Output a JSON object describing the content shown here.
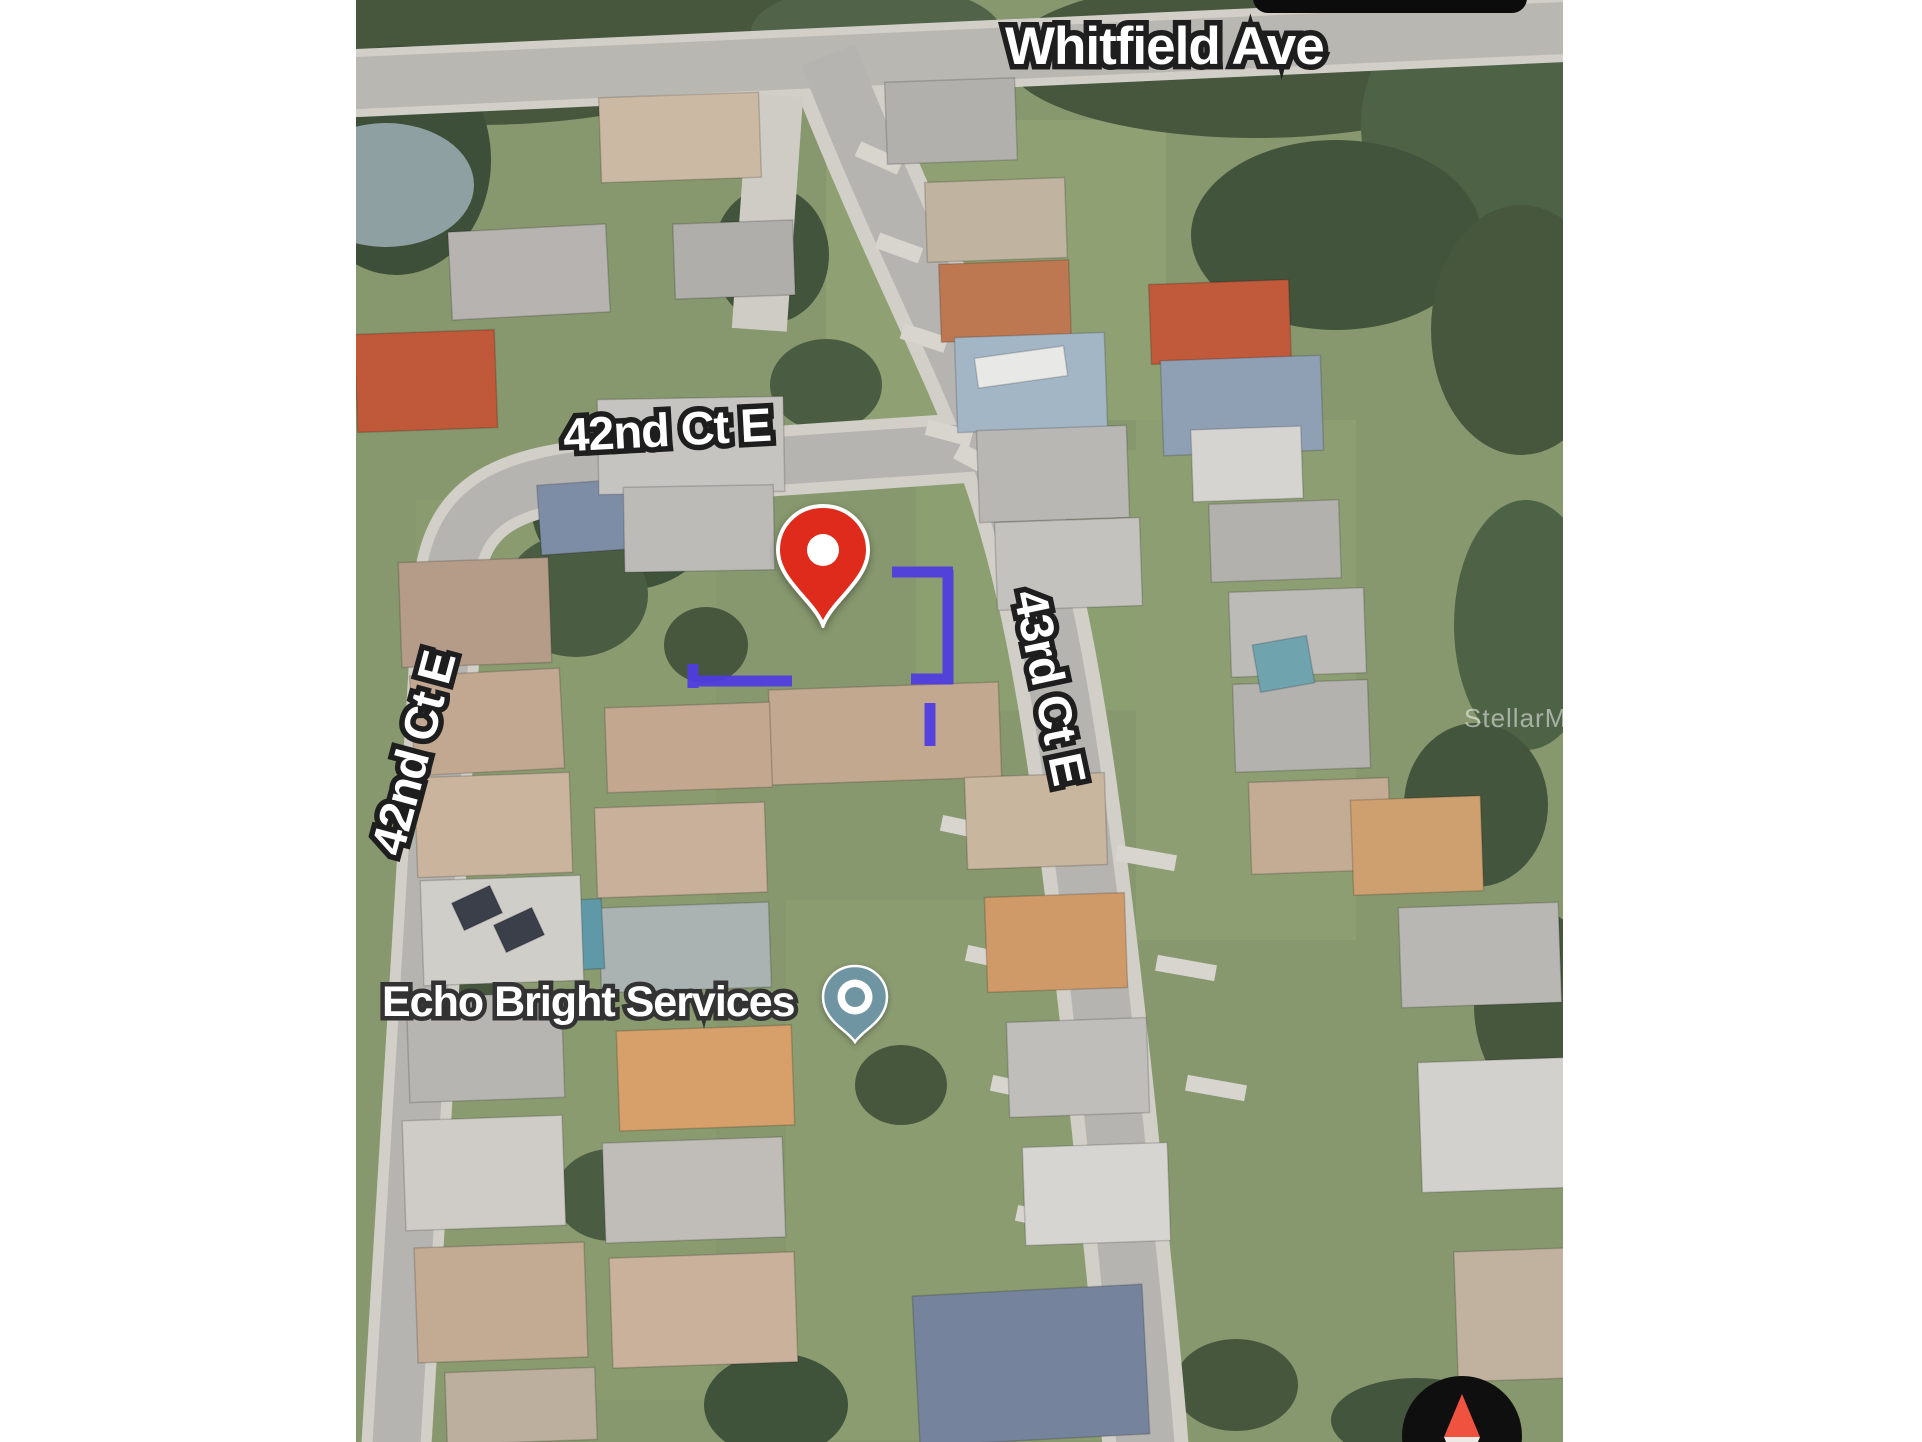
{
  "map_view": {
    "street_labels": [
      {
        "id": "whitfield-ave",
        "text": "Whitfield Ave"
      },
      {
        "id": "42nd-ct-e-horizontal",
        "text": "42nd Ct E"
      },
      {
        "id": "42nd-ct-e-vertical",
        "text": "42nd Ct E"
      },
      {
        "id": "43rd-ct-e-vertical",
        "text": "43rd Ct E"
      }
    ],
    "poi": {
      "name": "Echo Bright Services",
      "marker_color": "#6F95A3"
    },
    "property_pin": {
      "color": "#DE2B1C"
    },
    "parcel_outline": {
      "color": "#4F3BE3"
    },
    "watermark": {
      "text": "StellarMLS"
    },
    "compass": {
      "north_color": "#EF5340",
      "south_color": "#EDE9E4",
      "bg_color": "#0F0F0F"
    }
  }
}
